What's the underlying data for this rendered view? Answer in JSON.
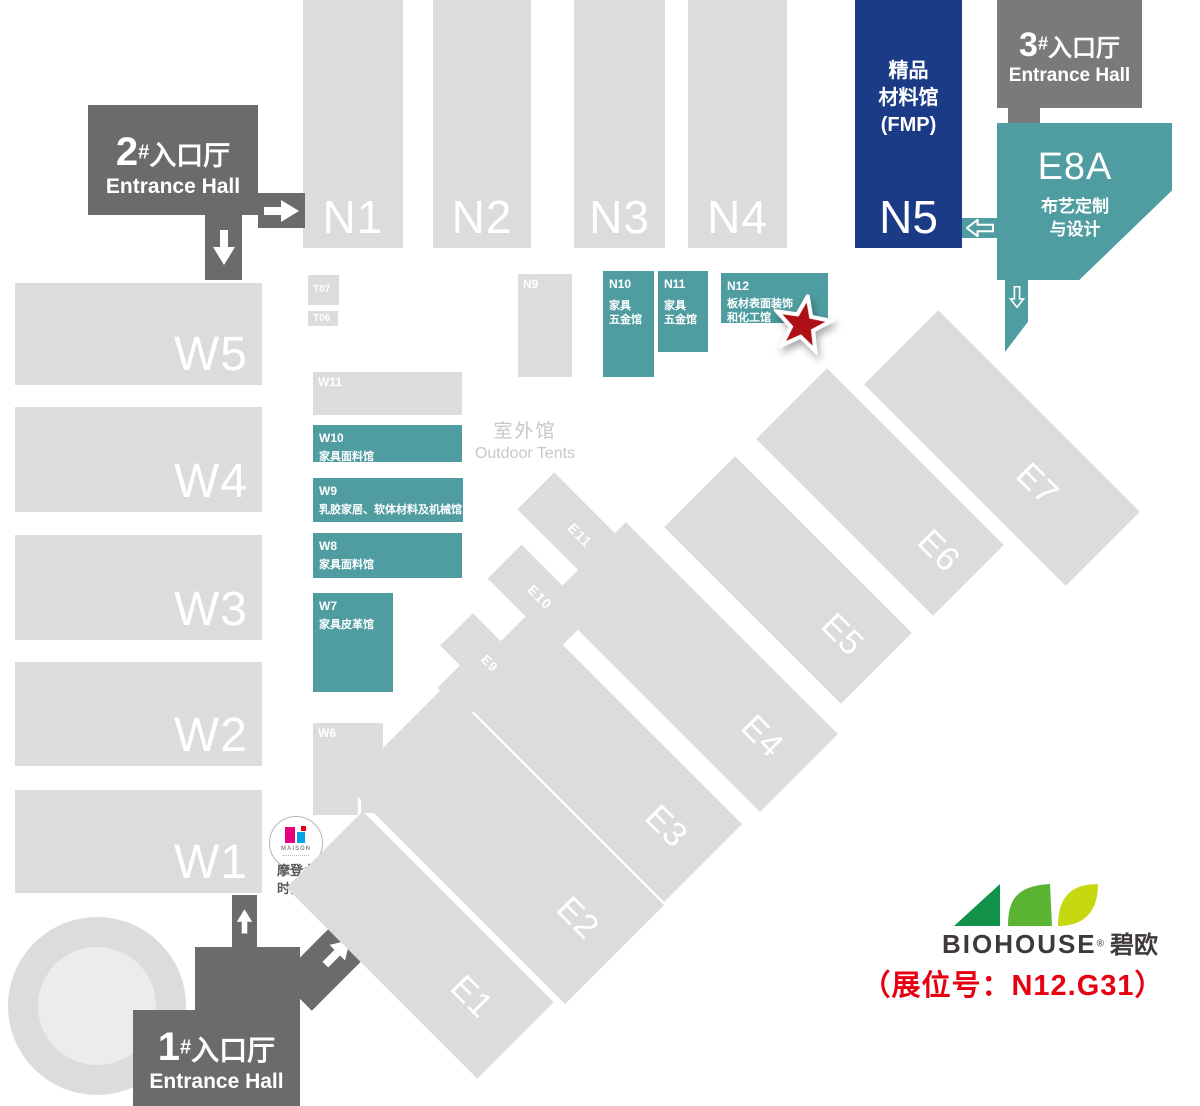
{
  "north": {
    "n1": "N1",
    "n2": "N2",
    "n3": "N3",
    "n4": "N4"
  },
  "n5": {
    "label": "N5",
    "line1": "精品",
    "line2": "材料馆",
    "line3": "(FMP)"
  },
  "e8a": {
    "label": "E8A",
    "line1": "布艺定制",
    "line2": "与设计"
  },
  "entrance1": {
    "num": "1",
    "hash": "#",
    "cn": "入口厅",
    "en": "Entrance Hall"
  },
  "entrance2": {
    "num": "2",
    "hash": "#",
    "cn": "入口厅",
    "en": "Entrance Hall"
  },
  "entrance3": {
    "num": "3",
    "hash": "#",
    "cn": "入口厅",
    "en": "Entrance Hall"
  },
  "west": {
    "w5": "W5",
    "w4": "W4",
    "w3": "W3",
    "w2": "W2",
    "w1": "W1"
  },
  "small": {
    "t07": "T07",
    "t06": "T06",
    "t01": "T01",
    "w11": "W11",
    "w6": "W6",
    "n9": "N9"
  },
  "nteal": {
    "n10": {
      "id": "N10",
      "l1": "家具",
      "l2": "五金馆"
    },
    "n11": {
      "id": "N11",
      "l1": "家具",
      "l2": "五金馆"
    },
    "n12": {
      "id": "N12",
      "l1": "板材表面装饰",
      "l2": "和化工馆"
    }
  },
  "wteal": {
    "w10": {
      "id": "W10",
      "desc": "家具面料馆"
    },
    "w9": {
      "id": "W9",
      "desc": "乳胶家居、软体材料及机械馆"
    },
    "w8": {
      "id": "W8",
      "desc": "家具面料馆"
    },
    "w7": {
      "id": "W7",
      "desc": "家具皮革馆"
    }
  },
  "outdoor": {
    "cn": "室外馆",
    "en": "Outdoor Tents"
  },
  "east": {
    "e1": "E1",
    "e2": "E2",
    "e3": "E3",
    "e4": "E4",
    "e5": "E5",
    "e6": "E6",
    "e7": "E7",
    "e9": "E9",
    "e10": "E10",
    "e11": "E11"
  },
  "shuttle": {
    "logo": "MAISON",
    "line1": "摩登上海",
    "line2": "时尚家居展班车"
  },
  "brand": {
    "name": "BIOHOUSE",
    "reg": "®",
    "cn": "碧欧",
    "booth": "（展位号：N12.G31）"
  },
  "colors": {
    "teal": "#4f9da1",
    "navy": "#1c3b87",
    "hall_gray": "#dcdcdc",
    "entrance_gray": "#6b6b6b",
    "star_red": "#ad1116",
    "booth_red": "#e60012",
    "leaf_dark_green": "#119149",
    "leaf_green": "#5bb431",
    "leaf_yellow": "#c6d80f"
  }
}
